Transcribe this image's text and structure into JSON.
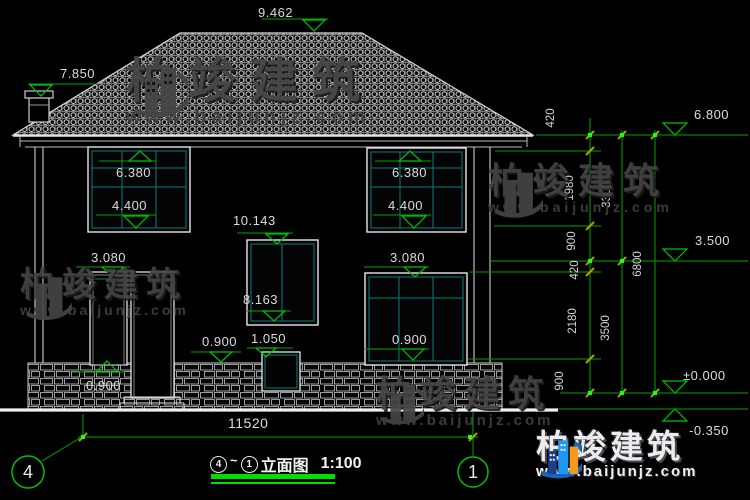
{
  "title": {
    "grid_left": "4",
    "tilde": "~",
    "grid_right": "1",
    "text": "立面图",
    "scale": "1:100"
  },
  "grid": {
    "left": "4",
    "right": "1"
  },
  "levels": {
    "ridge": "9.462",
    "chimney": "7.850",
    "eave": "6.800",
    "floor2": "3.500",
    "zero": "±0.000",
    "site": "-0.350"
  },
  "annotations": {
    "window2f": {
      "head": "6.380",
      "sill": "4.400"
    },
    "stair_window": {
      "head": "10.143",
      "sill": "8.163"
    },
    "floor1": {
      "head": "3.080",
      "sill": "0.900"
    },
    "small_window": {
      "head": "1.050",
      "side": "0.900"
    },
    "door": {
      "base": "0.900"
    }
  },
  "chains": {
    "inner": [
      "420",
      "1980",
      "900",
      "420",
      "2180",
      "900"
    ],
    "mid": [
      "3300",
      "3500"
    ],
    "total": "6800",
    "width": "11520"
  },
  "watermark": {
    "brand": "柏竣建筑",
    "url": "www.baijunjz.com"
  },
  "colors": {
    "dim_line": "#00a400",
    "marker": "#00c400",
    "tick": "#b49b00",
    "frame": "#0d7a7a",
    "underline": "#00dd00"
  }
}
